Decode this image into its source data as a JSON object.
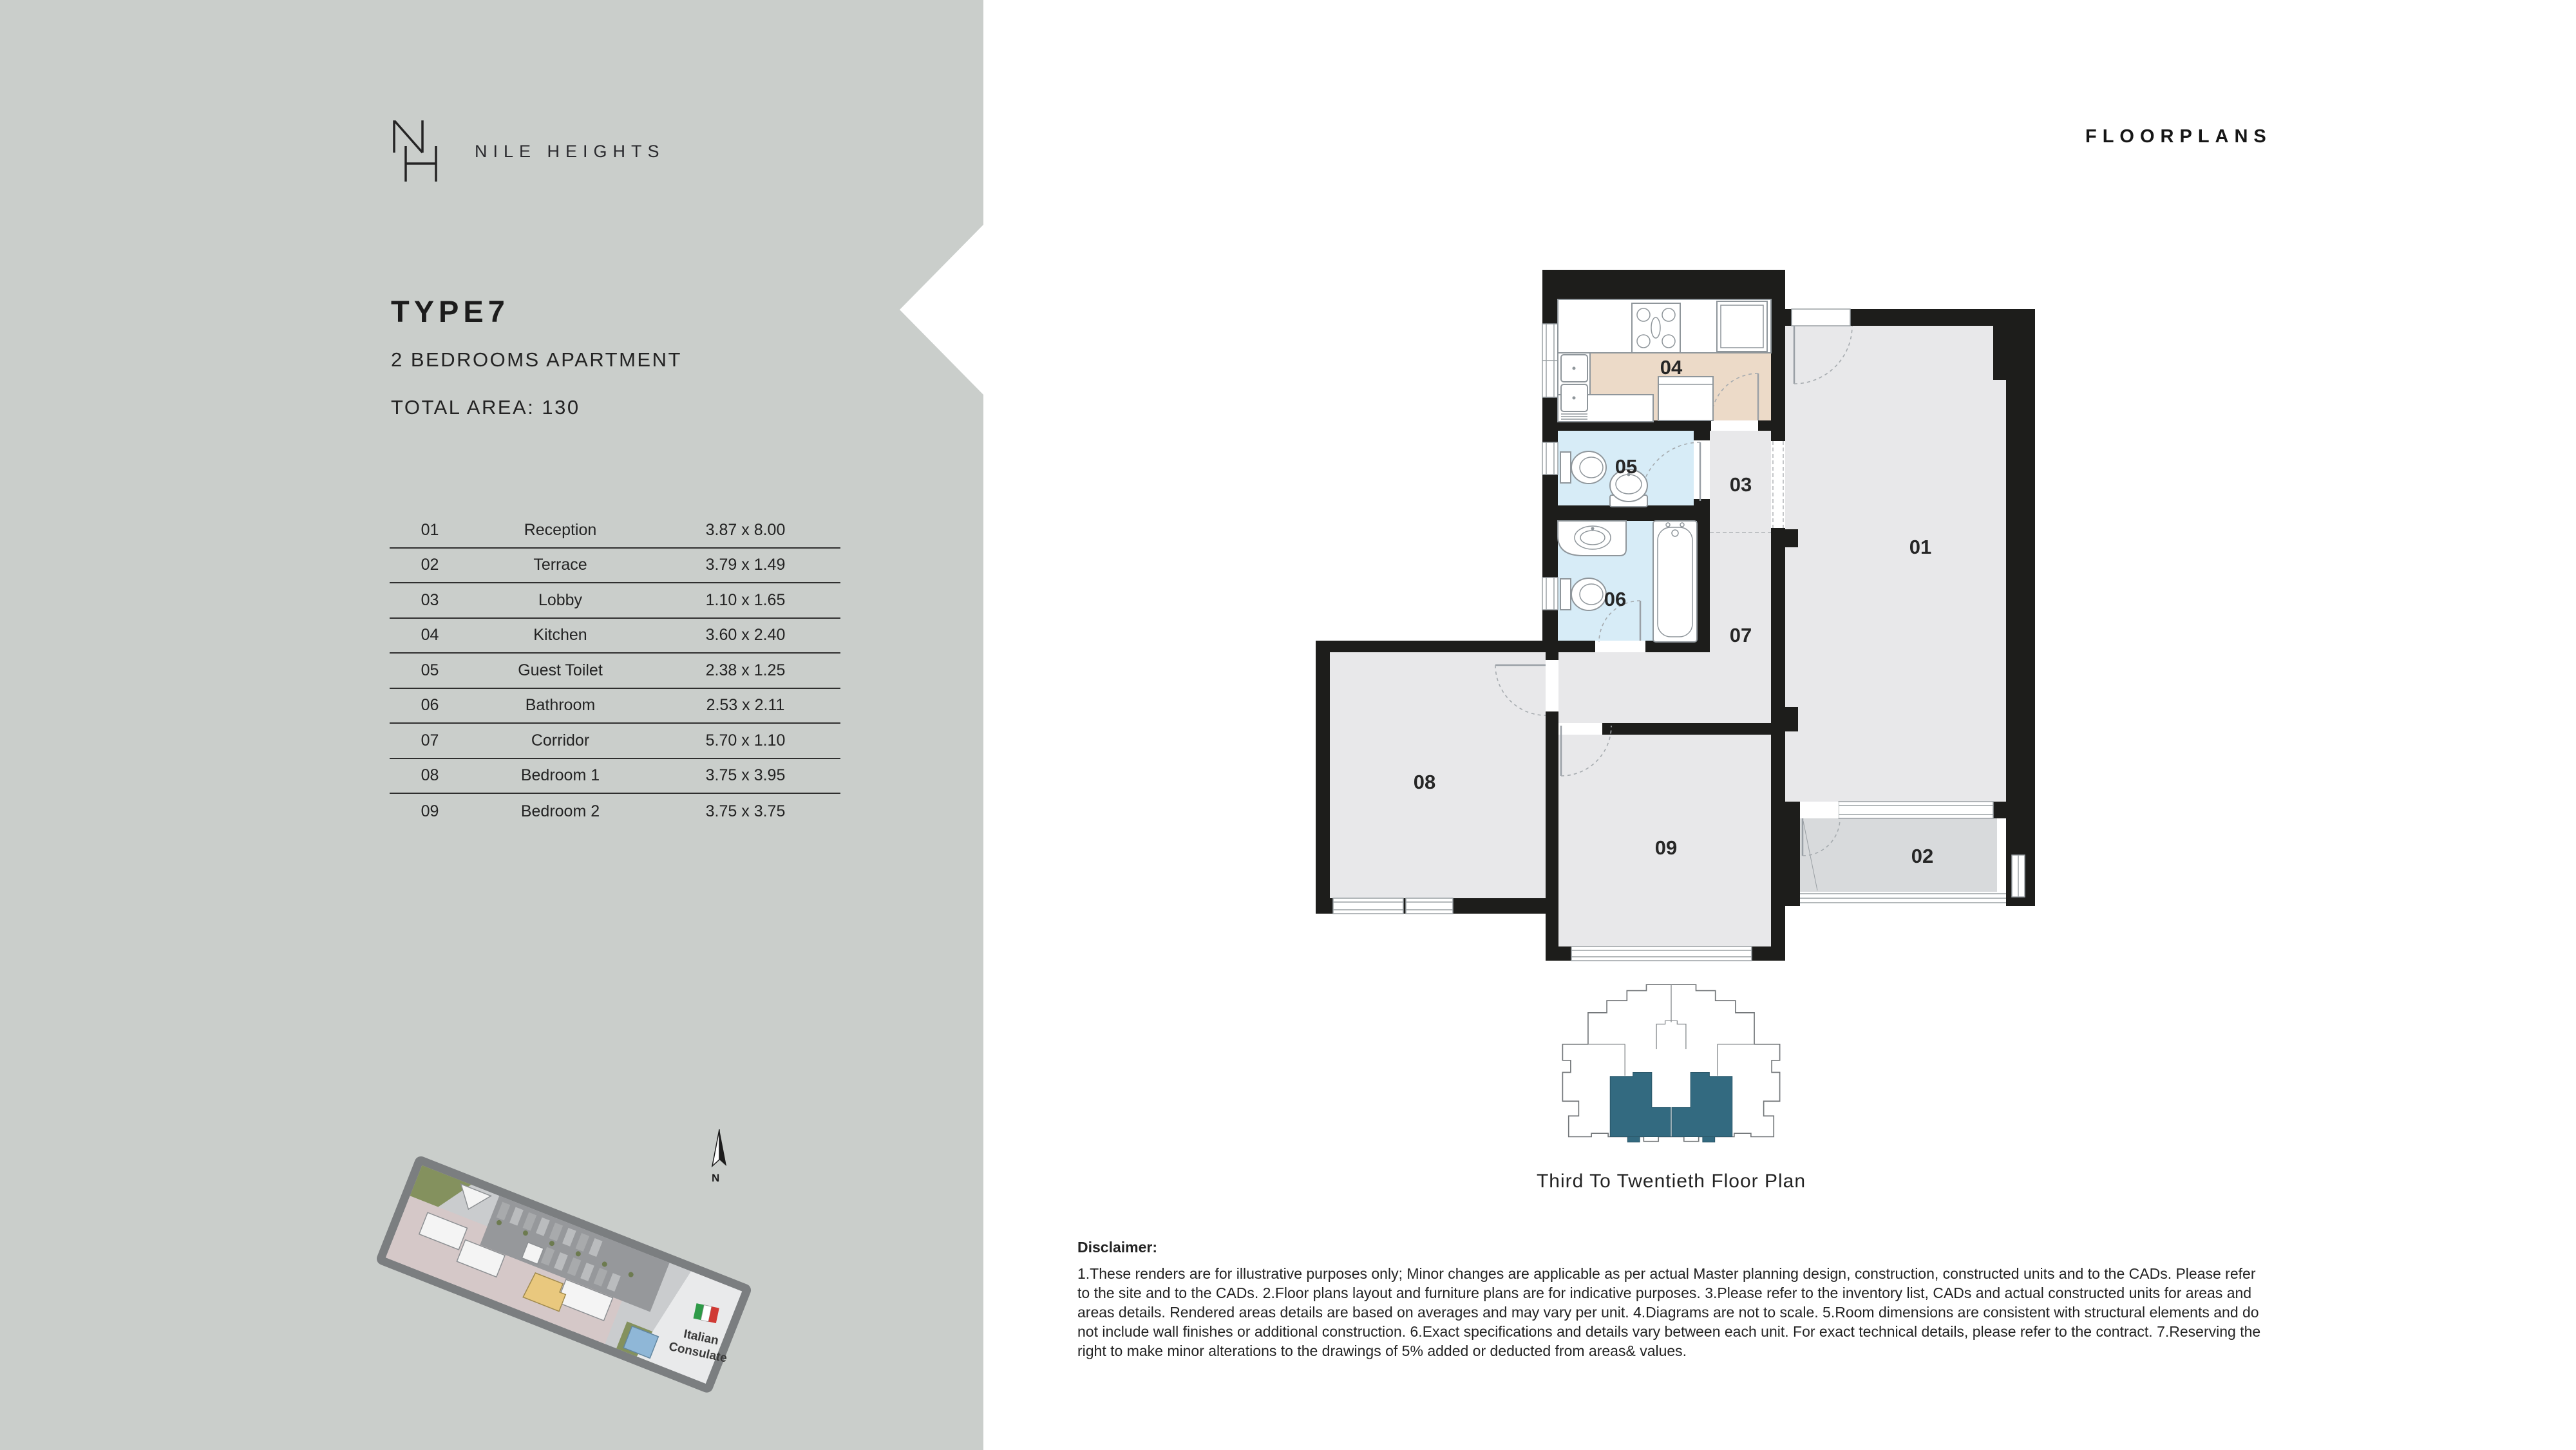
{
  "colors": {
    "sidebar_bg": "#cacecb",
    "ink": "#232323",
    "wall": "#1d1d1b",
    "room_fill": "#e8e8ea",
    "terrace_fill": "#d8dadc",
    "kitchen_fill": "#ecdac8",
    "bath_fill": "#d7ecf7",
    "line": "#9aa0a4",
    "teal": "#336a80",
    "site_road": "#7b7e80",
    "site_base": "#caccce",
    "site_ground": "#d5c8c8",
    "site_parking": "#96989b",
    "site_green": "#84915e",
    "site_yellow": "#e9c87e",
    "site_blue": "#8fb7d7",
    "flag_green": "#2e9a47",
    "flag_red": "#d03a34"
  },
  "sidebar": {
    "brand": "NILE HEIGHTS",
    "type_title": "TYPE7",
    "subtitle": "2 BEDROOMS APARTMENT",
    "total_area": "TOTAL AREA: 130",
    "table": {
      "rows": [
        {
          "no": "01",
          "name": "Reception",
          "dims": "3.87 x 8.00"
        },
        {
          "no": "02",
          "name": "Terrace",
          "dims": "3.79 x 1.49"
        },
        {
          "no": "03",
          "name": "Lobby",
          "dims": "1.10 x 1.65"
        },
        {
          "no": "04",
          "name": "Kitchen",
          "dims": "3.60 x 2.40"
        },
        {
          "no": "05",
          "name": "Guest Toilet",
          "dims": "2.38 x 1.25"
        },
        {
          "no": "06",
          "name": "Bathroom",
          "dims": "2.53 x 2.11"
        },
        {
          "no": "07",
          "name": "Corridor",
          "dims": "5.70 x 1.10"
        },
        {
          "no": "08",
          "name": "Bedroom 1",
          "dims": "3.75 x 3.95"
        },
        {
          "no": "09",
          "name": "Bedroom 2",
          "dims": "3.75 x 3.75"
        }
      ]
    }
  },
  "header": {
    "title": "FLOORPLANS"
  },
  "plan": {
    "labels": {
      "r01": "01",
      "r02": "02",
      "r03": "03",
      "r04": "04",
      "r05": "05",
      "r06": "06",
      "r07": "07",
      "r08": "08",
      "r09": "09"
    }
  },
  "keyplan": {
    "caption": "Third To Twentieth Floor Plan"
  },
  "siteplan": {
    "consulate_line1": "Italian",
    "consulate_line2": "Consulate",
    "north": "N"
  },
  "disclaimer": {
    "heading": "Disclaimer:",
    "body": "1.These renders are for illustrative purposes only; Minor changes are applicable as per actual Master planning design, construction, constructed units and to the CADs. Please refer to the site and to the CADs. 2.Floor plans layout and furniture plans are for indicative purposes. 3.Please refer to the inventory list, CADs and actual constructed units for areas and areas details. Rendered areas details are based on averages and may vary per unit. 4.Diagrams are not to scale. 5.Room dimensions are consistent with structural elements and do not include wall finishes or additional construction. 6.Exact specifications and details vary between each unit. For exact technical details, please refer to the contract. 7.Reserving the right to make minor alterations to the drawings of 5% added or deducted from areas& values."
  }
}
